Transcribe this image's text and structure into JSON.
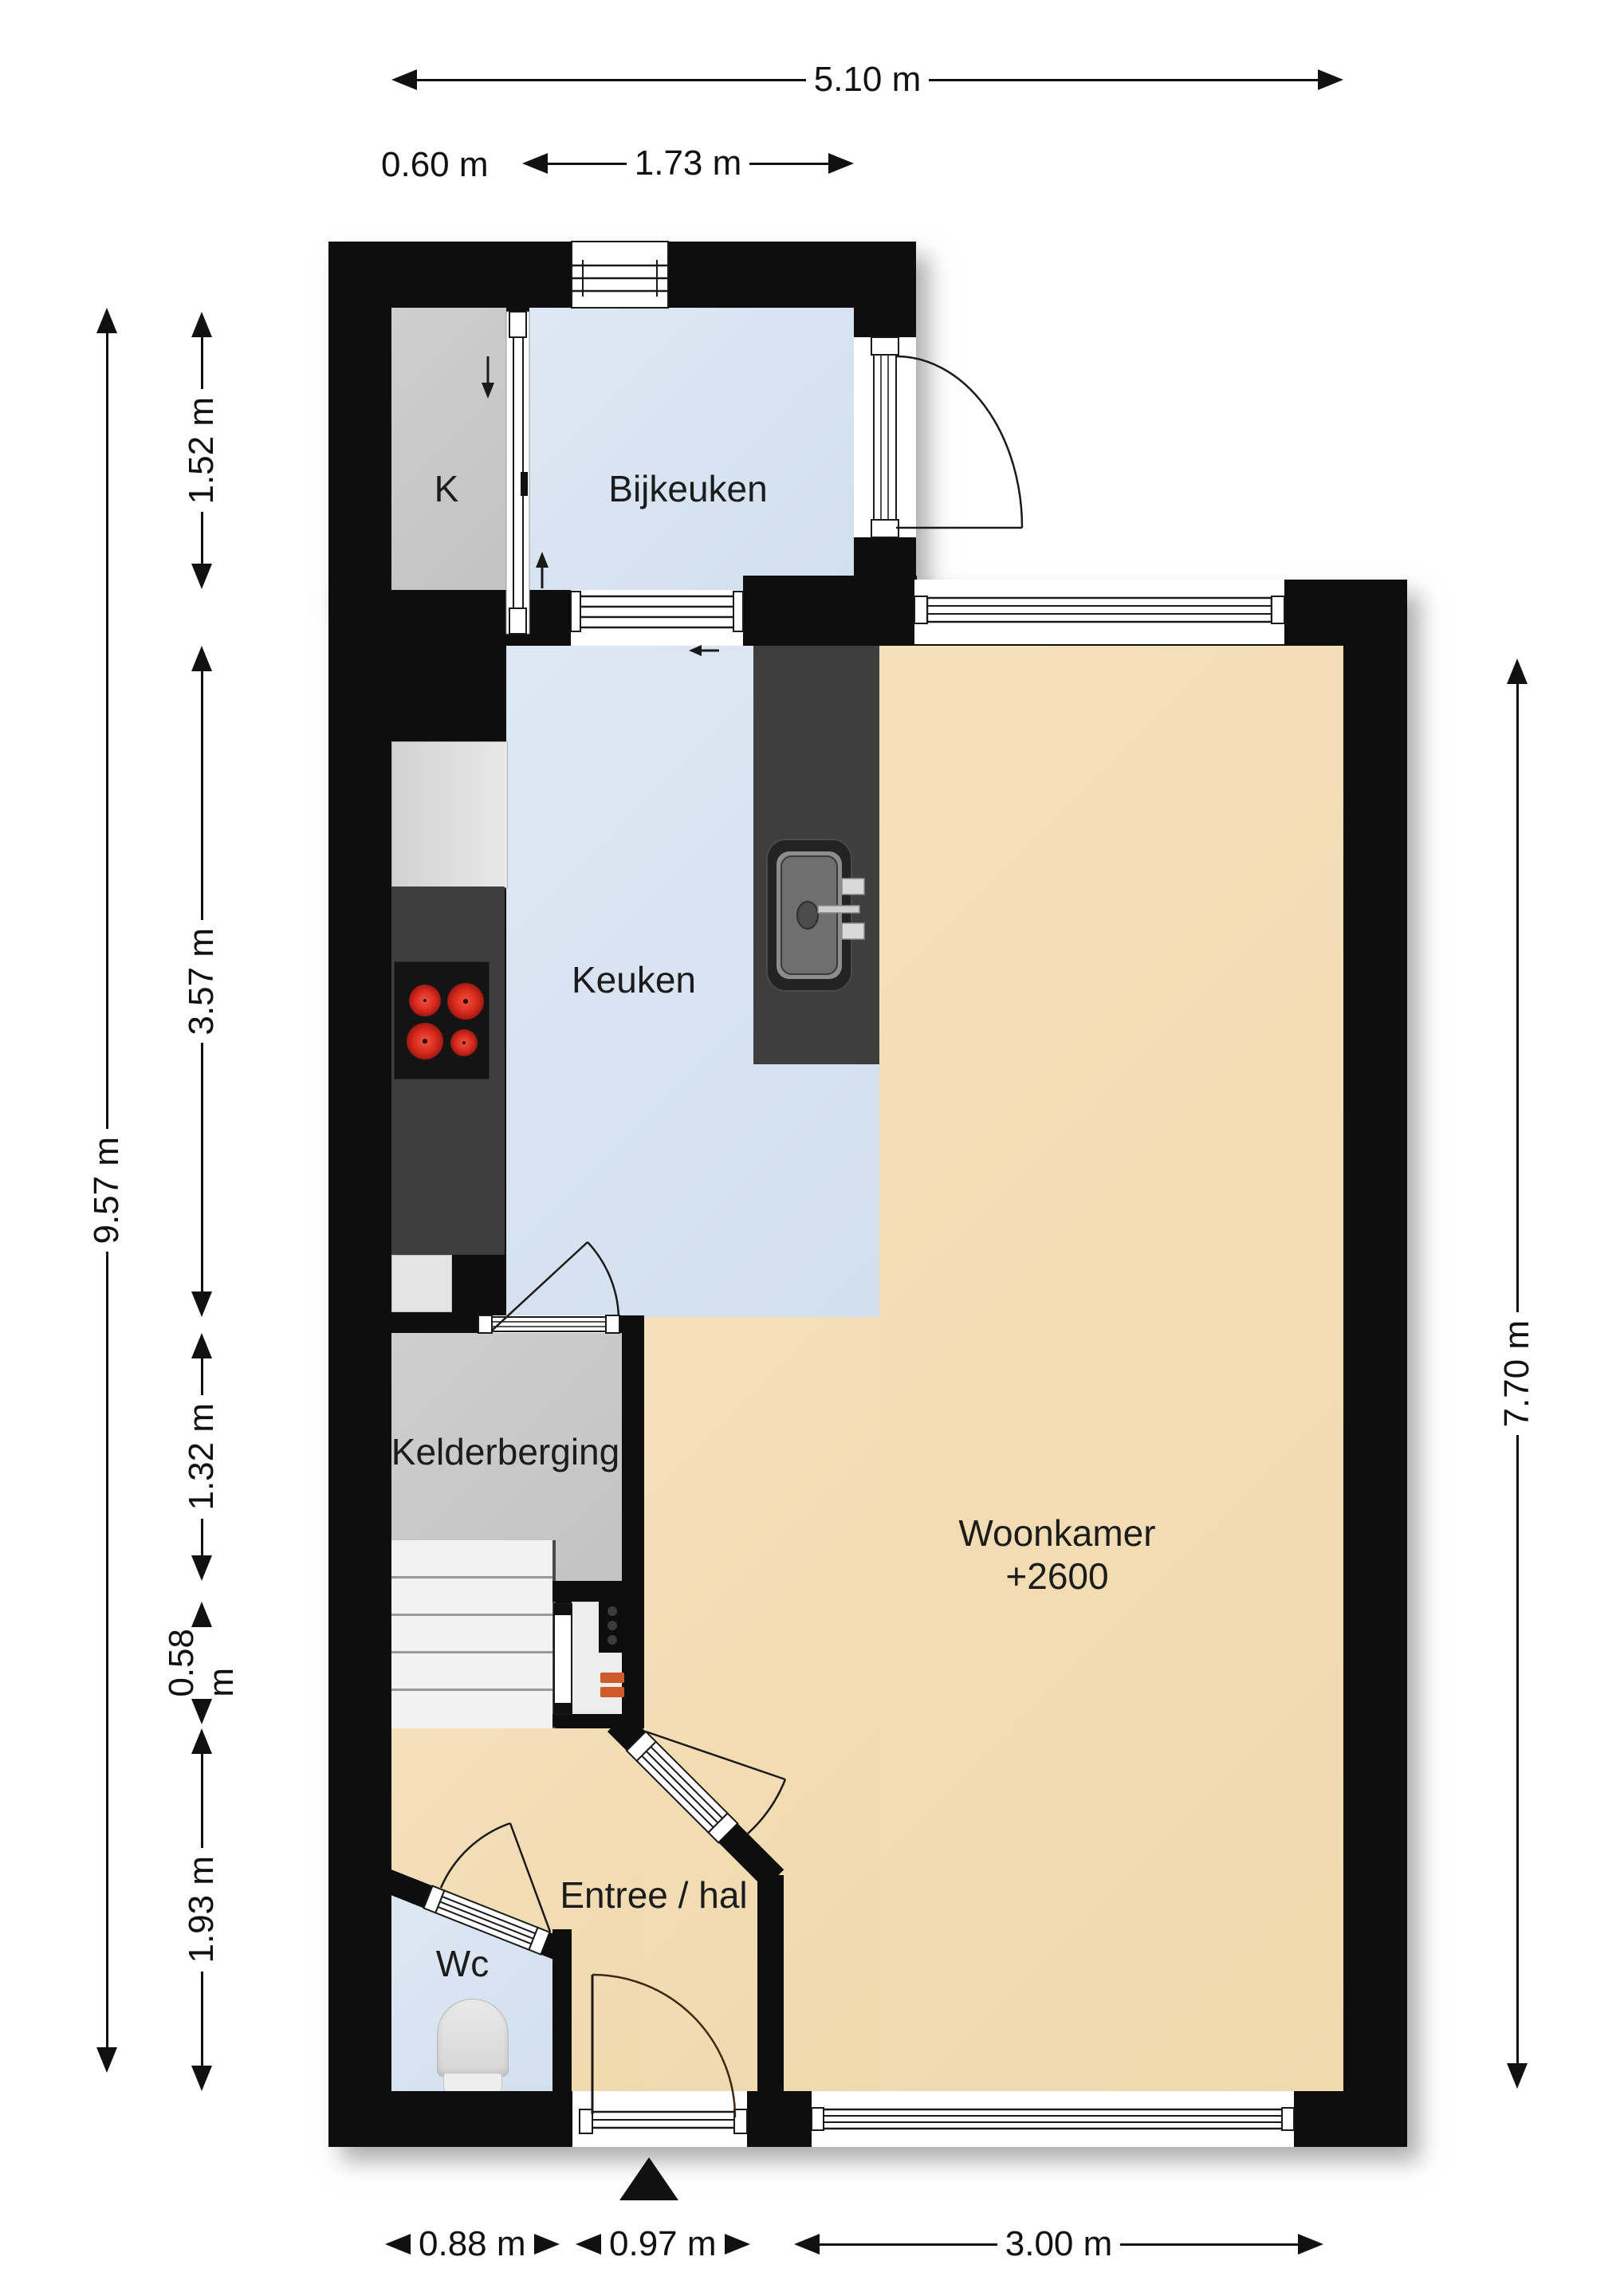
{
  "plan": {
    "rooms": {
      "k": {
        "label": "K"
      },
      "bijkeuken": {
        "label": "Bijkeuken"
      },
      "keuken": {
        "label": "Keuken"
      },
      "kelderberging": {
        "label": "Kelderberging"
      },
      "woonkamer": {
        "label": "Woonkamer",
        "ceiling_height": "+2600"
      },
      "entree": {
        "label": "Entree / hal"
      },
      "wc": {
        "label": "Wc"
      }
    },
    "dimensions": {
      "top_total": "5.10 m",
      "top_k_width": "0.60 m",
      "top_bijkeuken_width": "1.73 m",
      "left_total": "9.57 m",
      "left_bijkeuken": "1.52 m",
      "left_keuken": "3.57 m",
      "left_kelderberging": "1.32 m",
      "left_meterkast": "0.58 m",
      "left_entree": "1.93 m",
      "right_woonkamer": "7.70 m",
      "bottom_wc": "0.88 m",
      "bottom_entrance": "0.97 m",
      "bottom_woonkamer": "3.00 m"
    },
    "colors": {
      "wall": "#111111",
      "room_beige": "#f2dcb4",
      "room_blue": "#d8e4f0",
      "room_gray": "#c9c9c9",
      "counter_dark": "#3e3e3e",
      "burner_red": "#cf2b20",
      "meter_orange": "#cf5a2a"
    },
    "icons": {
      "entrance": "entrance-arrow-icon",
      "sink": "sink-icon",
      "stove": "stove-icon",
      "toilet": "toilet-icon",
      "stairs": "stairs-icon"
    }
  }
}
